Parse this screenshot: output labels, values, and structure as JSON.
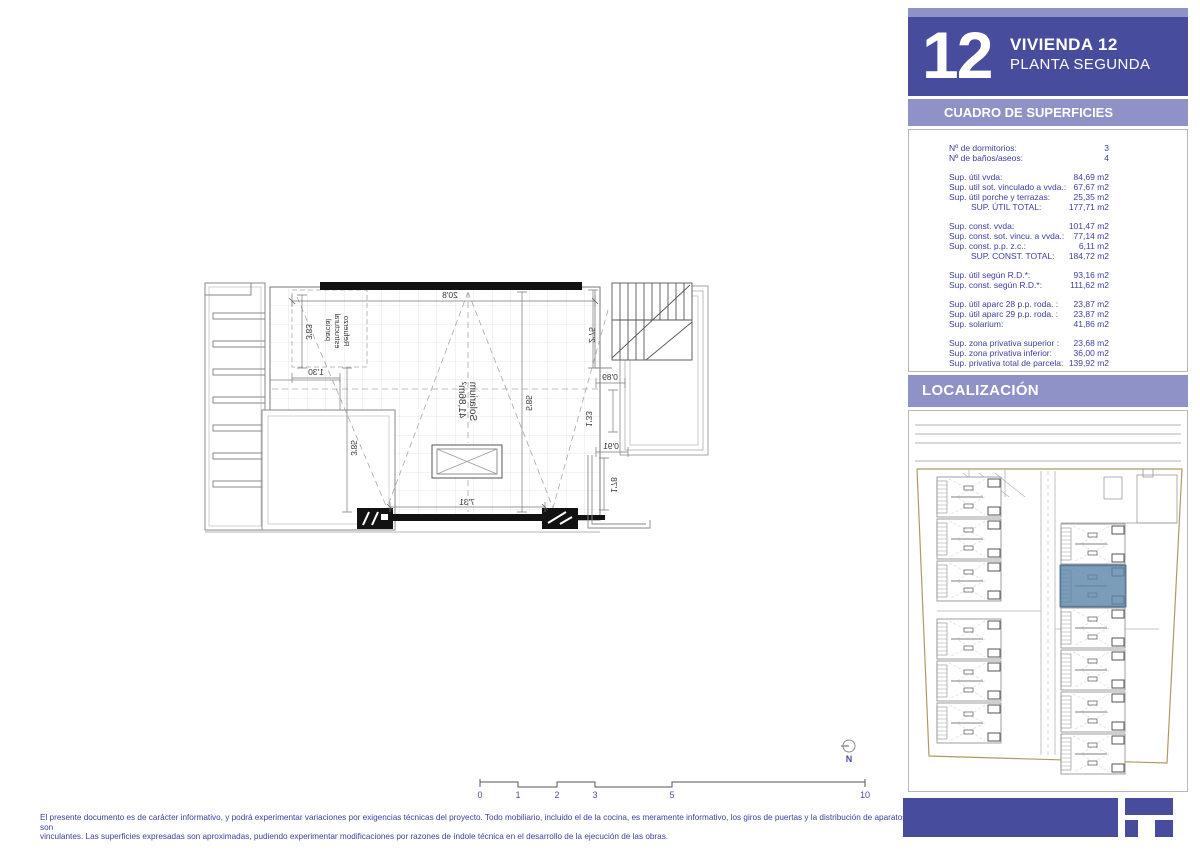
{
  "header": {
    "unit_number": "12",
    "title": "VIVIENDA 12",
    "subtitle": "PLANTA SEGUNDA"
  },
  "surfaces": {
    "heading": "CUADRO DE SUPERFICIES",
    "rows": [
      {
        "label": "Nº de dormitorios:",
        "value": "3"
      },
      {
        "label": "Nº de baños/aseos:",
        "value": "4"
      },
      {
        "label": "Sup. útil vvda:",
        "value": "84,69 m2"
      },
      {
        "label": "Sup. util sot. vinculado a vvda.:",
        "value": "67,67 m2"
      },
      {
        "label": "Sup. útil porche y terrazas:",
        "value": "25,35 m2"
      },
      {
        "label": "SUP. ÚTIL TOTAL:",
        "value": "177,71 m2"
      },
      {
        "label": "Sup. const. vvda:",
        "value": "101,47 m2"
      },
      {
        "label": "Sup. const. sot. vincu. a vvda.:",
        "value": "77,14 m2"
      },
      {
        "label": "Sup. const. p.p. z.c.:",
        "value": "6,11 m2"
      },
      {
        "label": "SUP. CONST. TOTAL:",
        "value": "184,72 m2"
      },
      {
        "label": "Sup. útil según R.D.*:",
        "value": "93,16 m2"
      },
      {
        "label": "Sup. const. según R.D.*:",
        "value": "111,62 m2"
      },
      {
        "label": "Sup. útil aparc 28 p.p. roda. :",
        "value": "23,87 m2"
      },
      {
        "label": "Sup. útil aparc 29 p.p. roda. :",
        "value": "23,87 m2"
      },
      {
        "label": "Sup. solarium:",
        "value": "41,86 m2"
      },
      {
        "label": "Sup. zona privativa superior :",
        "value": "23,68 m2"
      },
      {
        "label": "Sup. zona privativa inferior:",
        "value": "36,00 m2"
      },
      {
        "label": "Sup. privativa total de parcela:",
        "value": "139,92 m2"
      }
    ]
  },
  "localizacion": {
    "heading": "LOCALIZACIÓN"
  },
  "plan": {
    "room_label": {
      "line1": "Solarium",
      "line2": "41,86m²"
    },
    "note": {
      "line1": "Refuerzo",
      "line2": "estructural",
      "line3": "parcial"
    },
    "dimensions": {
      "top": "20'8",
      "left_upper": "3'83",
      "left_step": "1'30",
      "left_lower": "3'85",
      "center": "5'85",
      "right_upper": "2'75",
      "right_a": "0'89",
      "right_b": "1'33",
      "right_c": "0'91",
      "right_d": "1'78",
      "bottom": "7'31"
    }
  },
  "north": {
    "label": "N"
  },
  "scalebar": {
    "labels": [
      "0",
      "1",
      "2",
      "3",
      "5",
      "10"
    ]
  },
  "disclaimer": {
    "line1": "El presente documento es de carácter informativo, y podrá experimentar variaciones por exigencias técnicas del proyecto. Todo mobiliario, incluido el de la cocina, es meramente informativo, los giros de puertas y la distribución de aparatos sanitarios no son",
    "line2": "vinculantes. Las superficies expresadas son aproximadas, pudiendo experimentar modificaciones por razones de índole técnica en el desarrollo de la ejecución de las obras."
  },
  "colors": {
    "brand_dark": "#474c9d",
    "brand_light": "#8f92c7",
    "text_blue": "#3c40a0",
    "highlight_unit": "#5b84a8",
    "boundary_tan": "#b09a62"
  }
}
